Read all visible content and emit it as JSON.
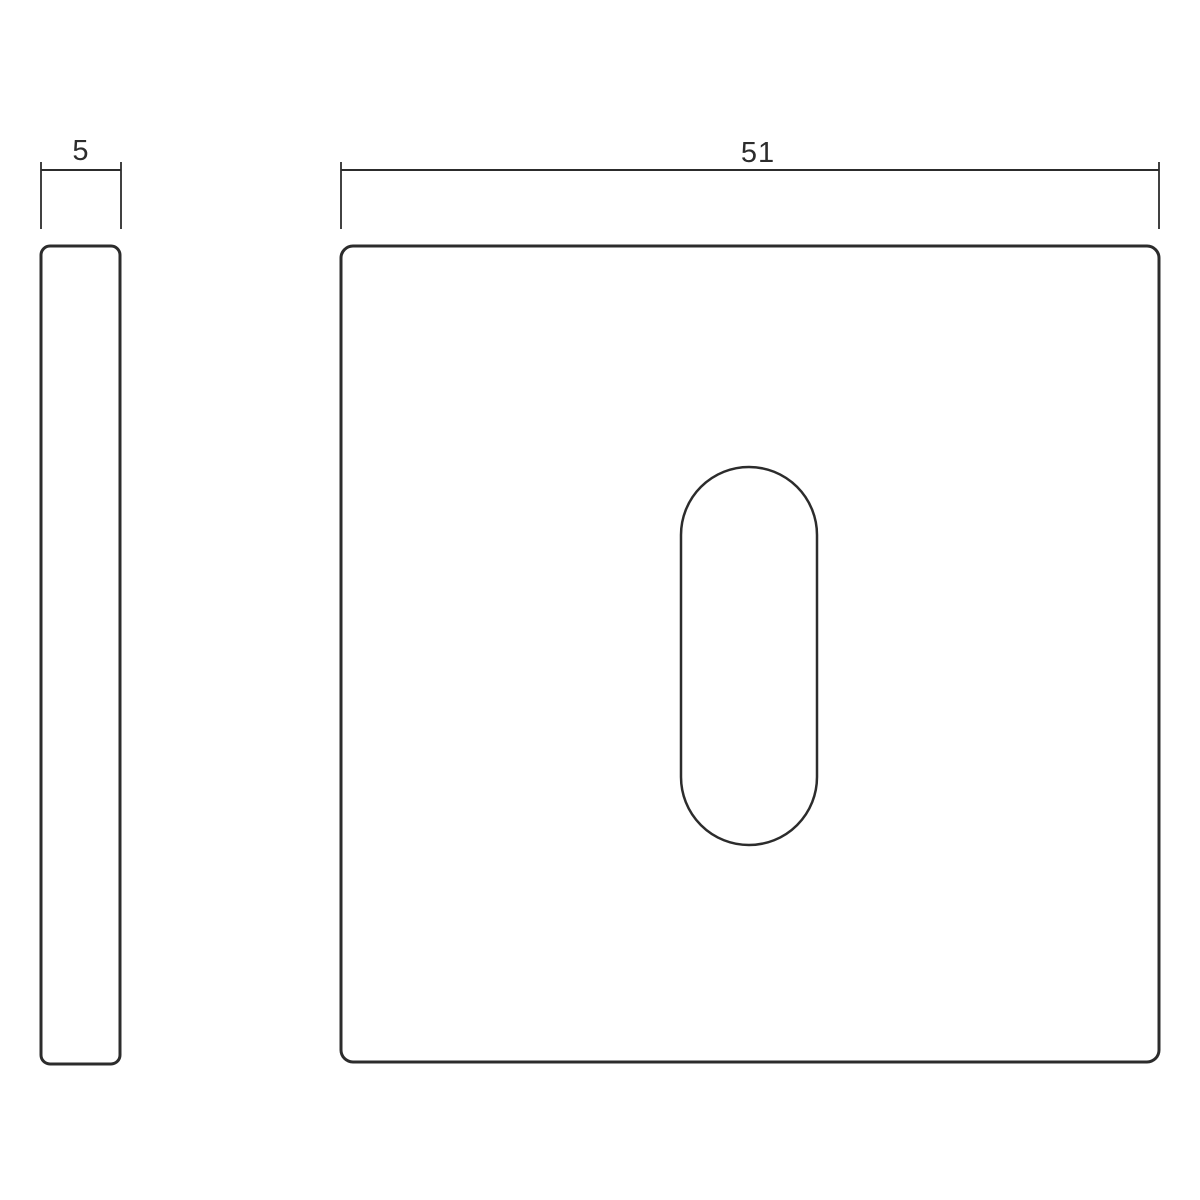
{
  "drawing": {
    "background_color": "#ffffff",
    "line_color": "#2c2c2c",
    "dimension_labels": {
      "side_thickness": "5",
      "front_width": "51"
    }
  }
}
